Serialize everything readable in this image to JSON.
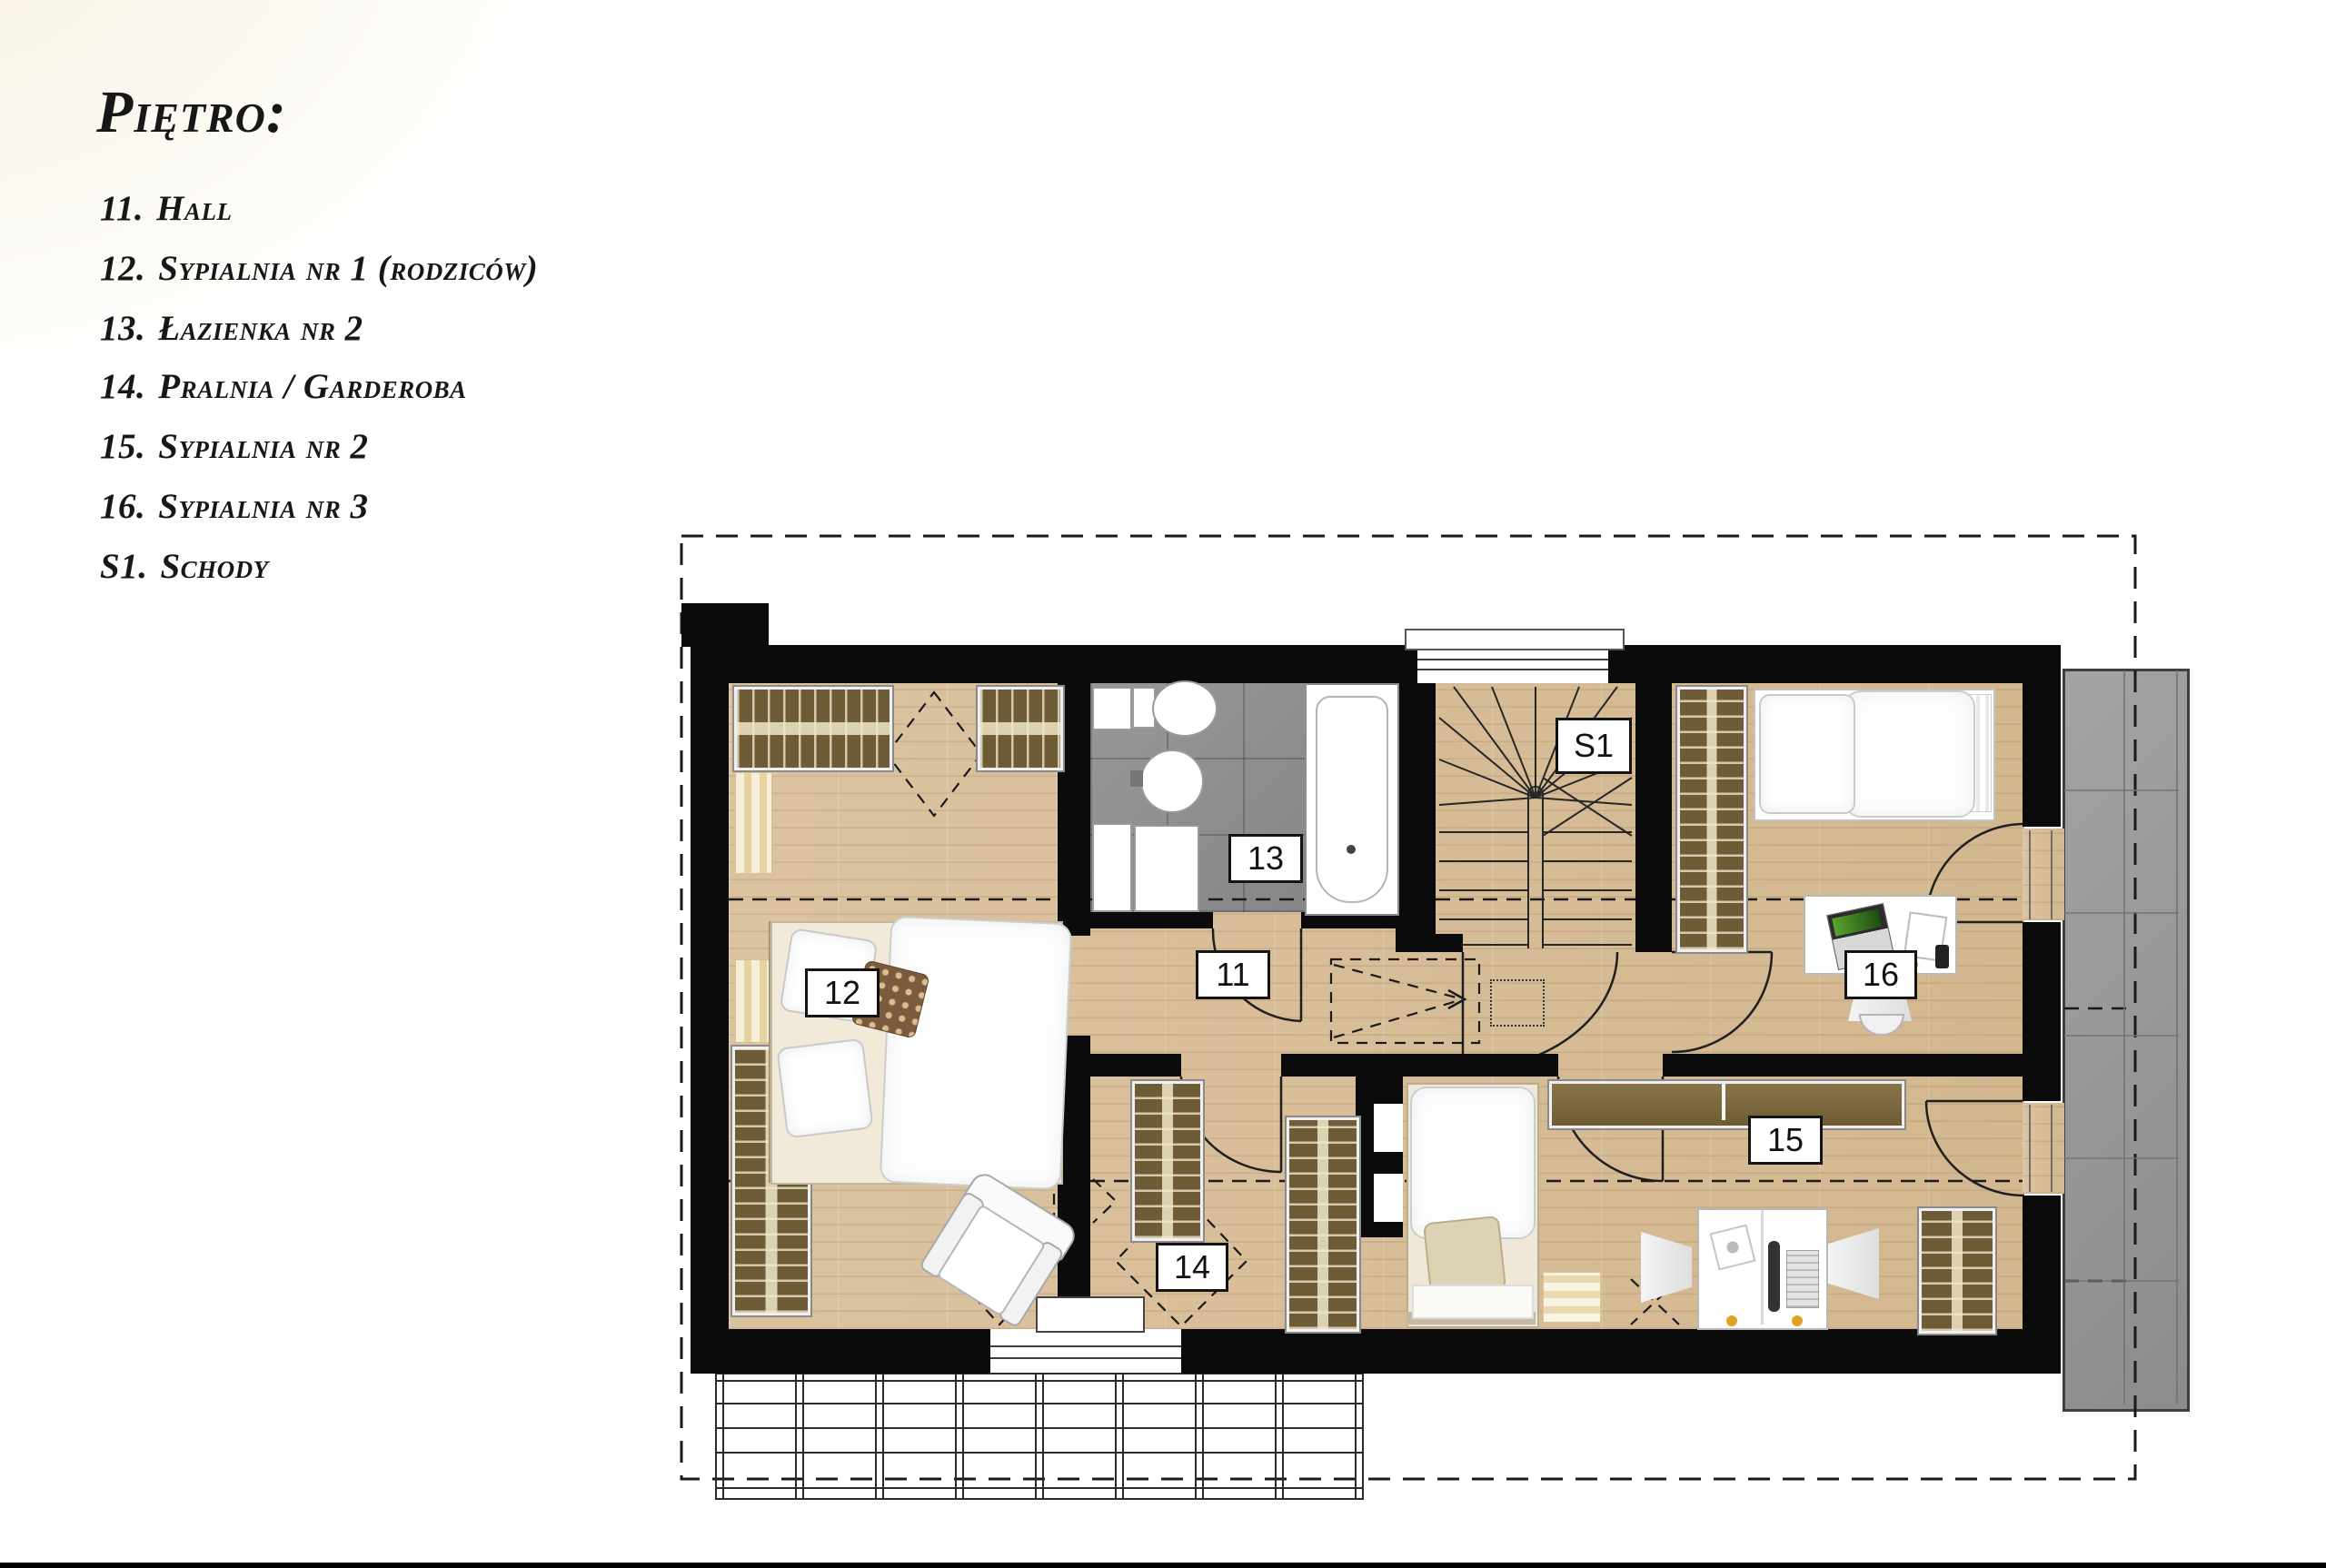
{
  "legend": {
    "title": "Piętro:",
    "items": [
      {
        "num": "11.",
        "label": "Hall"
      },
      {
        "num": "12.",
        "label": "Sypialnia nr 1 (rodziców)"
      },
      {
        "num": "13.",
        "label": "Łazienka nr 2"
      },
      {
        "num": "14.",
        "label": "Pralnia / Garderoba"
      },
      {
        "num": "15.",
        "label": "Sypialnia nr 2"
      },
      {
        "num": "16.",
        "label": "Sypialnia nr 3"
      },
      {
        "num": "S1.",
        "label": "Schody"
      }
    ]
  },
  "plan": {
    "labels": {
      "hall": "11",
      "bedroom1": "12",
      "bathroom": "13",
      "laundry": "14",
      "bedroom2": "15",
      "bedroom3": "16",
      "stairs": "S1"
    },
    "colors": {
      "wall": "#0b0b0b",
      "wood": "#d9c09c",
      "tile": "#8d8d8d",
      "balcony": "#9c9c9c",
      "wardrobe": "#6d5c36",
      "gold_pillow": "#c9ae4e"
    }
  }
}
